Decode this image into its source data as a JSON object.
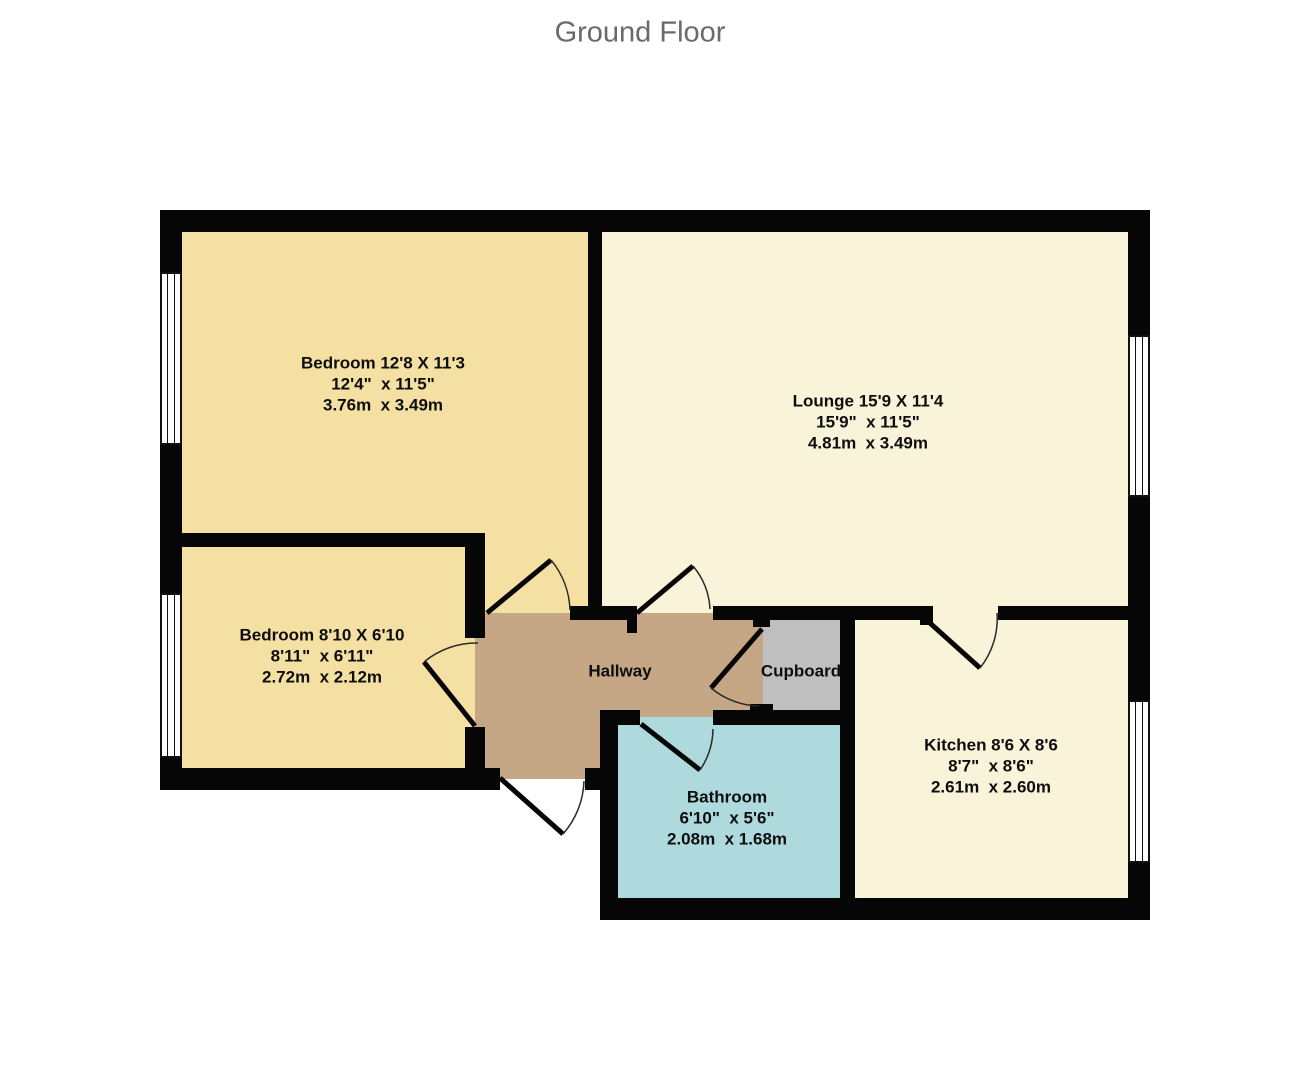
{
  "title": "Ground Floor",
  "rooms": {
    "bedroom1": {
      "name": "Bedroom 12'8 X 11'3",
      "imperial": "12'4\"  x 11'5\"",
      "metric": "3.76m  x 3.49m"
    },
    "lounge": {
      "name": "Lounge 15'9 X 11'4",
      "imperial": "15'9\"  x 11'5\"",
      "metric": "4.81m  x 3.49m"
    },
    "bedroom2": {
      "name": "Bedroom 8'10 X 6'10",
      "imperial": "8'11\"  x 6'11\"",
      "metric": "2.72m  x 2.12m"
    },
    "kitchen": {
      "name": "Kitchen 8'6 X 8'6",
      "imperial": "8'7\"  x 8'6\"",
      "metric": "2.61m  x 2.60m"
    },
    "bathroom": {
      "name": "Bathroom",
      "imperial": "6'10\"  x 5'6\"",
      "metric": "2.08m  x 1.68m"
    },
    "hallway": {
      "name": "Hallway"
    },
    "cupboard": {
      "name": "Cupboard"
    }
  },
  "colors": {
    "bedroom": "#f5e0a3",
    "living": "#f8f3d9",
    "hallway": "#c5a685",
    "cupboard": "#bfbfbf",
    "bathroom": "#aedade",
    "wall": "#060606",
    "window_frame": "#111111",
    "title_text": "#6a6a6a",
    "label_text": "#0d0d0d"
  }
}
